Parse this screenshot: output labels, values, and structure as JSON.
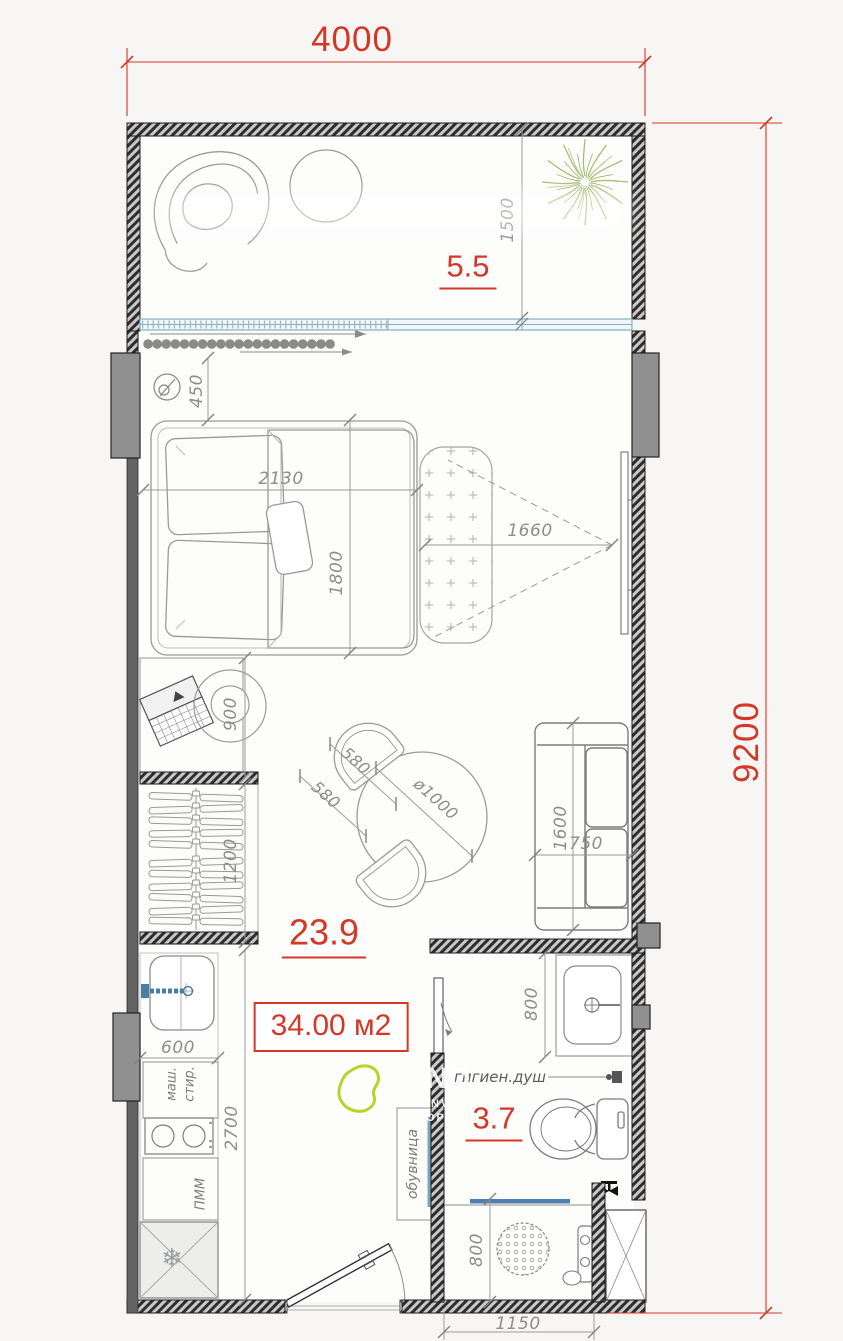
{
  "overall_dims": {
    "width": "4000",
    "height": "9200"
  },
  "areas": {
    "balcony": "5.5",
    "room": "23.9",
    "bathroom": "3.7",
    "total": "34.00 м2"
  },
  "dims": {
    "balcony_depth": "1500",
    "wall_to_bed": "450",
    "bed_length": "2130",
    "bed_width": "1800",
    "tv_distance": "1660",
    "desk_depth": "900",
    "wardrobe_width": "1200",
    "chair_a": "580",
    "chair_b": "580",
    "table_diameter": "ø1000",
    "sofa_length": "1600",
    "sofa_depth": "750",
    "kitchen_width": "600",
    "kitchen_run": "2700",
    "bath_sink_width": "800",
    "shower_width": "800",
    "shower_outer": "1150"
  },
  "labels": {
    "washing_machine_line1": "стир.",
    "washing_machine_line2": "маш.",
    "dishwasher": "ПММ",
    "shoe_cabinet": "обувница",
    "hygienic_shower": "гигиен.душ"
  },
  "icons": {
    "fridge_snowflake": "❄"
  },
  "watermark": {
    "line1": "ND",
    "line2": "INV",
    "line3": "OP"
  },
  "colors": {
    "dimension_red": "#d43726",
    "dimension_gray": "#8d8d8d",
    "window_blue": "#85aec5",
    "glass_blue": "#4f7fae",
    "plant_green": "#a9bd72",
    "marker_green": "#b8d42a"
  }
}
